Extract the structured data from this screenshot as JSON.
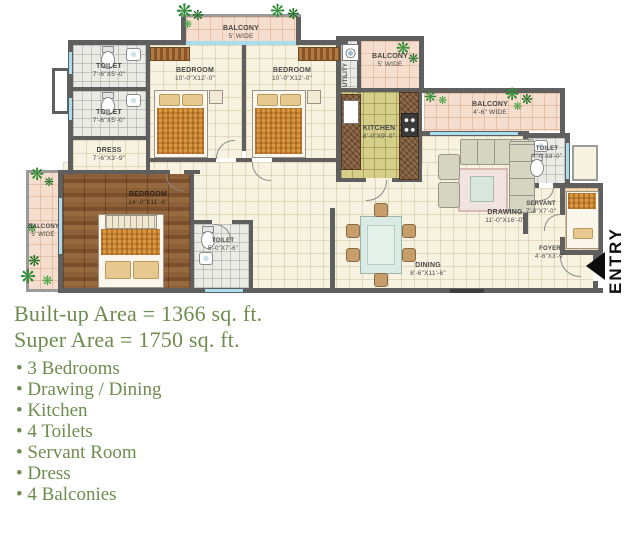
{
  "plan": {
    "entry_label": "ENTRY",
    "balcony_top": {
      "name": "BALCONY",
      "dim": "5' WIDE"
    },
    "toilet_1": {
      "name": "TOILET",
      "dim": "7'-6\"X5'-0\""
    },
    "toilet_2": {
      "name": "TOILET",
      "dim": "7'-6\"X5'-0\""
    },
    "dress": {
      "name": "DRESS",
      "dim": "7'-6\"X3'-9\""
    },
    "bedroom_1": {
      "name": "BEDROOM",
      "dim": "10'-0\"X12'-0\""
    },
    "bedroom_2": {
      "name": "BEDROOM",
      "dim": "10'-0\"X12'-0\""
    },
    "utility": {
      "name": "UTILITY",
      "dim": ""
    },
    "balcony_service": {
      "name": "BALCONY",
      "dim": "5' WIDE"
    },
    "kitchen": {
      "name": "KITCHEN",
      "dim": "8'-0\"X9'-0\""
    },
    "balcony_rear": {
      "name": "BALCONY",
      "dim": "4'-6\" WIDE"
    },
    "toilet_3": {
      "name": "TOILET",
      "dim": "4'-0\"X8'-0\""
    },
    "drawing": {
      "name": "DRAWING",
      "dim": "11'-0\"X16'-0\""
    },
    "servant": {
      "name": "SERVANT",
      "dim": "7'-0\"X7'-0\""
    },
    "dining": {
      "name": "DINING",
      "dim": "8'-6\"X11'-6\""
    },
    "foyer": {
      "name": "FOYER",
      "dim": "4'-6\"X3'-9\""
    },
    "bedroom_master": {
      "name": "BEDROOM",
      "dim": "14'-0\"X11'-6\""
    },
    "toilet_master": {
      "name": "TOILET",
      "dim": "5'-0\"X7'-6\""
    },
    "balcony_left": {
      "name": "BALCONY",
      "dim": "5' WIDE"
    }
  },
  "summary": {
    "built_up": "Built-up Area = 1366 sq. ft.",
    "super": "Super Area = 1750 sq. ft.",
    "features": [
      "3 Bedrooms",
      "Drawing / Dining",
      "Kitchen",
      "4 Toilets",
      "Servant Room",
      "Dress",
      "4 Balconies"
    ]
  },
  "colors": {
    "wall": "#5f5f5f",
    "summary_text": "#6e8c4e",
    "balcony_floor": "#f5decd",
    "wood_floor": "#85552f",
    "kitchen_floor": "#d6cf8a",
    "window": "#a8dcee"
  }
}
